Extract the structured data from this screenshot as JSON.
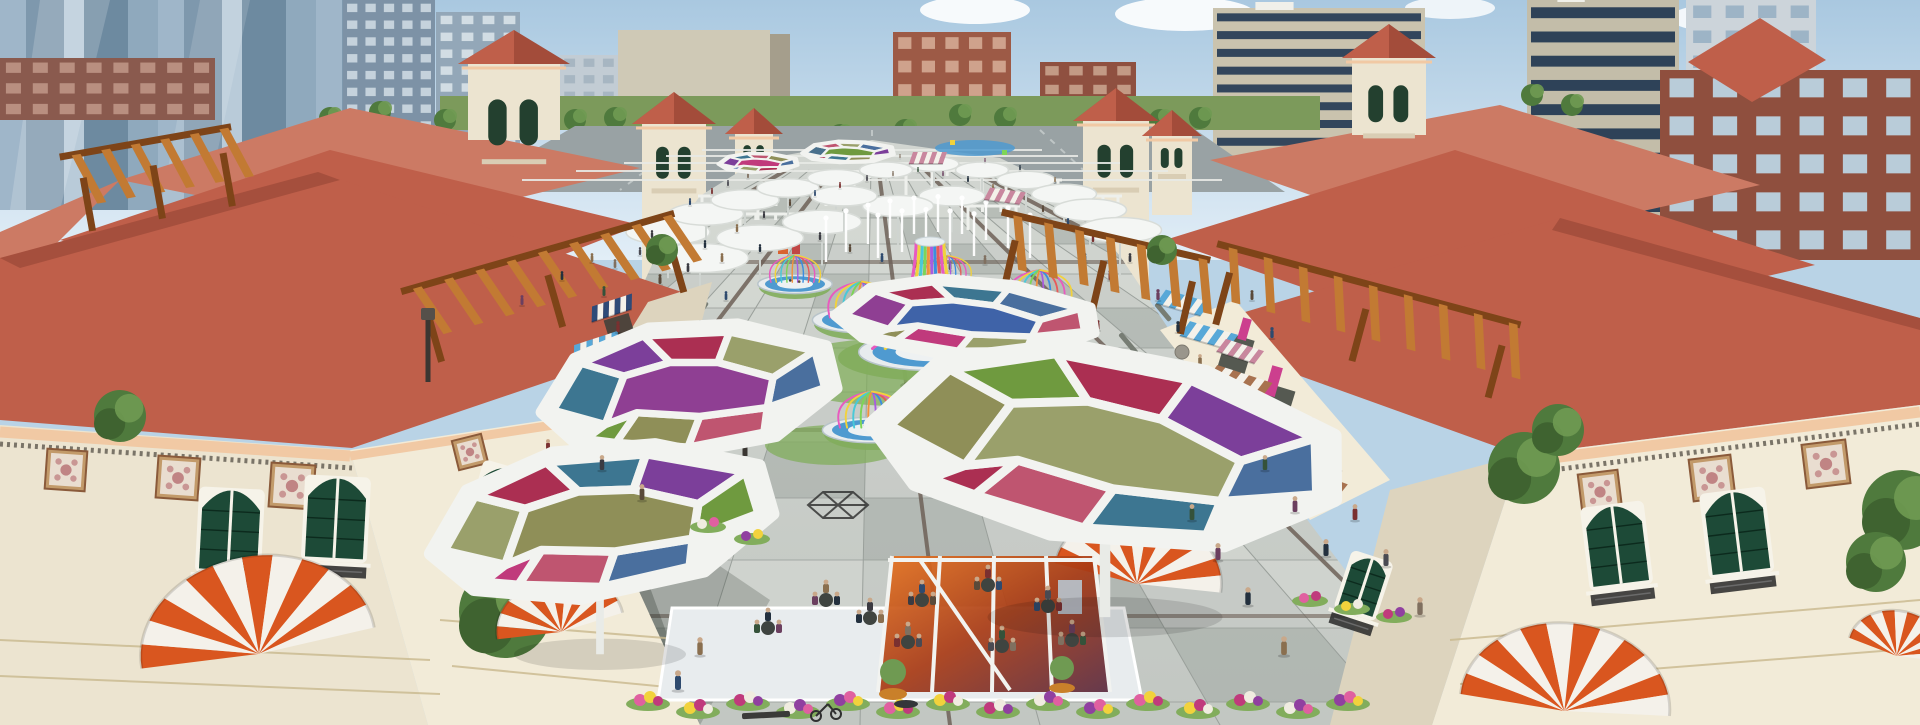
{
  "scene": {
    "title": "Aerial architectural rendering of a Mediterranean-style outdoor shopping plaza with colorful canopies"
  },
  "palette": {
    "skyTop": "#a9c8e0",
    "skyBot": "#e2eef7",
    "cloud": "#ffffff",
    "roofMain": "#bf5f4a",
    "roofPale": "#cc7a64",
    "roofDark": "#a34c3a",
    "roofLine": "#8c3f2f",
    "wallCream": "#ece4d0",
    "wallLit": "#f2ebd8",
    "wallShade": "#ddd4be",
    "stoneBase": "#d8c89e",
    "cornice": "#f1c9a4",
    "frieze": "#7a7468",
    "frameWhite": "#f6f3e9",
    "greenWindow": "#1d4a37",
    "ironDark": "#2e2e2e",
    "woodPergola": "#c27a33",
    "woodDark": "#7e4418",
    "awnOrange": "#d9561f",
    "awnBrown": "#a8724f",
    "awnBlue": "#57a8d8",
    "awnNavy": "#2e4a78",
    "awnPink": "#c9879e",
    "signMagenta": "#cc3f8e",
    "paveLight": "#d7dad5",
    "paveMid": "#c6cbc6",
    "paveDark": "#a3a9a4",
    "joint": "#9aa09b",
    "accentBrown": "#6e6158",
    "grass": "#7c9a5b",
    "lawn": "#82ad5c",
    "treeGreen": "#4f7a3d",
    "treeLight": "#6f9a52",
    "road": "#99a2a4",
    "waterBlue": "#4f9ad0",
    "platform": "#e8ecee",
    "rimGray": "#b8c4ca",
    "olive": "#8f8f58",
    "sage": "#9aa06b",
    "leaf": "#6f9a3f",
    "teal": "#3d7691",
    "steel": "#49708c",
    "blue": "#3f63a8",
    "plum": "#7c3f9a",
    "violet": "#8f3f93",
    "crimson": "#ab2f52",
    "rose": "#bf5570",
    "magenta": "#c03a7c",
    "denim": "#4a6f9e"
  },
  "rainbow": [
    "#e85abf",
    "#f2d23c",
    "#49c9d8",
    "#7ed557",
    "#f2913c",
    "#a95ce0",
    "#3c8de0",
    "#e85a5a"
  ],
  "city": {
    "glassStripes": {
      "x": 0,
      "y": 0,
      "w": 345,
      "h": 210,
      "colors": [
        "#9fb6c9",
        "#7e98ad",
        "#b9cbd9",
        "#6d8aa0",
        "#8fa9bd"
      ]
    },
    "buildings": [
      {
        "name": "left-tower-a",
        "x": 343,
        "y": 0,
        "w": 92,
        "h": 168,
        "body": "#7d92a6",
        "win": "#c5d2dc",
        "rows": 10,
        "cols": 5,
        "type": "grid"
      },
      {
        "name": "left-tower-b",
        "x": 436,
        "y": 12,
        "w": 84,
        "h": 152,
        "body": "#93a7b8",
        "win": "#d2dde4",
        "rows": 9,
        "cols": 4,
        "type": "grid"
      },
      {
        "name": "left-brick-low",
        "x": 0,
        "y": 58,
        "w": 215,
        "h": 62,
        "body": "#8a5a4e",
        "win": "#b98f80",
        "rows": 3,
        "cols": 8,
        "type": "grid"
      },
      {
        "name": "white-slab",
        "x": 560,
        "y": 55,
        "w": 58,
        "h": 66,
        "body": "#c2ccd4",
        "win": "#a7b6c2",
        "rows": 4,
        "cols": 3,
        "type": "grid"
      },
      {
        "name": "beige-block",
        "x": 618,
        "y": 30,
        "w": 152,
        "h": 96,
        "body": "#cfc9b6",
        "win": "#b1aa96",
        "rows": 0,
        "cols": 0,
        "type": "flat"
      },
      {
        "name": "beige-block-side",
        "x": 770,
        "y": 34,
        "w": 20,
        "h": 92,
        "body": "#a59e8c",
        "win": "#a59e8c",
        "rows": 0,
        "cols": 0,
        "type": "flat"
      },
      {
        "name": "red-brick-center",
        "x": 893,
        "y": 32,
        "w": 118,
        "h": 94,
        "body": "#9d5a46",
        "win": "#cfa28c",
        "rows": 4,
        "cols": 5,
        "type": "grid"
      },
      {
        "name": "red-brick-annex",
        "x": 1040,
        "y": 62,
        "w": 96,
        "h": 56,
        "body": "#8f5040",
        "win": "#c39a85",
        "rows": 3,
        "cols": 4,
        "type": "grid"
      },
      {
        "name": "right-residential",
        "x": 1213,
        "y": 8,
        "w": 212,
        "h": 160,
        "body": "#cac3ae",
        "win": "#33465c",
        "rows": 9,
        "cols": 1,
        "type": "bands"
      },
      {
        "name": "far-right-tower-a",
        "x": 1527,
        "y": 0,
        "w": 152,
        "h": 315,
        "body": "#c3bda9",
        "win": "#2e4258",
        "rows": 13,
        "cols": 1,
        "type": "bands"
      },
      {
        "name": "far-right-tower-b",
        "x": 1686,
        "y": 0,
        "w": 130,
        "h": 150,
        "body": "#ccd4da",
        "win": "#9db4c6",
        "rows": 6,
        "cols": 4,
        "type": "grid"
      },
      {
        "name": "far-right-brick",
        "x": 1660,
        "y": 70,
        "w": 260,
        "h": 190,
        "body": "#8f4f3e",
        "win": "#b9ccd9",
        "rows": 5,
        "cols": 6,
        "type": "grid"
      }
    ],
    "trees": [
      [
        330,
        118
      ],
      [
        380,
        112
      ],
      [
        445,
        120
      ],
      [
        520,
        116
      ],
      [
        575,
        120
      ],
      [
        615,
        118
      ],
      [
        960,
        115
      ],
      [
        1005,
        118
      ],
      [
        1160,
        120
      ],
      [
        1200,
        118
      ],
      [
        1445,
        150
      ],
      [
        1490,
        160
      ],
      [
        1060,
        228
      ],
      [
        1012,
        242
      ],
      [
        482,
        215
      ],
      [
        446,
        230
      ],
      [
        1532,
        95
      ],
      [
        1572,
        105
      ],
      [
        905,
        130
      ],
      [
        840,
        135
      ]
    ]
  },
  "medTowers": [
    {
      "x": 642,
      "w": 64,
      "top": 118,
      "bot": 305,
      "apex": 92
    },
    {
      "x": 735,
      "w": 38,
      "top": 128,
      "bot": 215,
      "apex": 108
    },
    {
      "x": 1083,
      "w": 66,
      "top": 115,
      "bot": 300,
      "apex": 88
    },
    {
      "x": 1152,
      "w": 40,
      "top": 130,
      "bot": 215,
      "apex": 110
    },
    {
      "x": 468,
      "w": 92,
      "top": 58,
      "bot": 140,
      "apex": 30
    },
    {
      "x": 1352,
      "w": 74,
      "top": 52,
      "bot": 135,
      "apex": 24
    }
  ],
  "canopies": [
    {
      "cx": 848,
      "cy": 152,
      "rx": 46,
      "ry": 14,
      "rot": 0,
      "colors": [
        "steel",
        "rose",
        "sage",
        "denim",
        "plum",
        "olive",
        "teal",
        "crimson",
        "leaf",
        "steel"
      ]
    },
    {
      "cx": 758,
      "cy": 163,
      "rx": 40,
      "ry": 13,
      "rot": 0,
      "colors": [
        "plum",
        "teal",
        "rose",
        "olive",
        "denim",
        "crimson",
        "sage",
        "blue",
        "magenta",
        "steel"
      ]
    },
    {
      "cx": 965,
      "cy": 318,
      "rx": 130,
      "ry": 50,
      "rot": 3,
      "colors": [
        "violet",
        "crimson",
        "teal",
        "denim",
        "rose",
        "sage",
        "magenta",
        "olive",
        "blue",
        "plum"
      ]
    },
    {
      "cx": 688,
      "cy": 390,
      "rx": 148,
      "ry": 86,
      "rot": -6,
      "colors": [
        "teal",
        "plum",
        "crimson",
        "sage",
        "denim",
        "rose",
        "olive",
        "leaf",
        "violet",
        "steel"
      ]
    },
    {
      "cx": 1105,
      "cy": 447,
      "rx": 235,
      "ry": 126,
      "rot": 8,
      "colors": [
        "olive",
        "leaf",
        "crimson",
        "plum",
        "denim",
        "teal",
        "rose",
        "crimson",
        "sage",
        "blue"
      ]
    },
    {
      "cx": 600,
      "cy": 522,
      "rx": 172,
      "ry": 98,
      "rot": -8,
      "colors": [
        "sage",
        "crimson",
        "teal",
        "plum",
        "leaf",
        "denim",
        "rose",
        "magenta",
        "olive",
        "crimson"
      ]
    }
  ],
  "pavilions": [
    {
      "cx": 795,
      "cy": 284,
      "s": 0.6,
      "t": "dome"
    },
    {
      "cx": 948,
      "cy": 282,
      "s": 0.55,
      "t": "dome"
    },
    {
      "cx": 862,
      "cy": 320,
      "s": 0.8,
      "t": "dome"
    },
    {
      "cx": 1040,
      "cy": 306,
      "s": 0.75,
      "t": "dome"
    },
    {
      "cx": 930,
      "cy": 352,
      "s": 1.15,
      "t": "vase"
    },
    {
      "cx": 872,
      "cy": 430,
      "s": 0.8,
      "t": "dome"
    },
    {
      "cx": 1088,
      "cy": 410,
      "s": 0.85,
      "t": "dome"
    },
    {
      "cx": 1012,
      "cy": 464,
      "s": 1.25,
      "t": "vase"
    }
  ],
  "umbrellas": [
    [
      668,
      232
    ],
    [
      706,
      214
    ],
    [
      745,
      200
    ],
    [
      788,
      188
    ],
    [
      836,
      178
    ],
    [
      886,
      170
    ],
    [
      934,
      164
    ],
    [
      982,
      170
    ],
    [
      1026,
      180
    ],
    [
      1064,
      194
    ],
    [
      700,
      258
    ],
    [
      760,
      238
    ],
    [
      822,
      222
    ],
    [
      1090,
      210
    ],
    [
      952,
      196
    ],
    [
      898,
      206
    ],
    [
      844,
      196
    ],
    [
      1120,
      230
    ]
  ],
  "jets": [
    [
      826,
      262
    ],
    [
      846,
      252
    ],
    [
      868,
      244
    ],
    [
      890,
      238
    ],
    [
      914,
      234
    ],
    [
      938,
      232
    ],
    [
      962,
      234
    ],
    [
      986,
      240
    ],
    [
      1008,
      248
    ],
    [
      1030,
      258
    ],
    [
      878,
      258
    ],
    [
      902,
      252
    ],
    [
      926,
      250
    ],
    [
      950,
      252
    ],
    [
      974,
      256
    ]
  ],
  "whiteFrames": [
    [
      698,
      196,
      64
    ],
    [
      772,
      182,
      58
    ],
    [
      850,
      172,
      60
    ],
    [
      928,
      170,
      58
    ],
    [
      1002,
      180,
      60
    ],
    [
      1066,
      196,
      56
    ],
    [
      736,
      214,
      60
    ],
    [
      964,
      206,
      56
    ]
  ],
  "people": {
    "far": [
      [
        652,
        238,
        8
      ],
      [
        672,
        220,
        7
      ],
      [
        690,
        205,
        7
      ],
      [
        712,
        194,
        6
      ],
      [
        728,
        186,
        6
      ],
      [
        748,
        178,
        6
      ],
      [
        770,
        170,
        5
      ],
      [
        795,
        163,
        5
      ],
      [
        705,
        248,
        8
      ],
      [
        737,
        232,
        8
      ],
      [
        764,
        218,
        7
      ],
      [
        790,
        206,
        7
      ],
      [
        815,
        196,
        6
      ],
      [
        840,
        188,
        6
      ],
      [
        867,
        181,
        6
      ],
      [
        893,
        176,
        5
      ],
      [
        918,
        172,
        5
      ],
      [
        943,
        176,
        5
      ],
      [
        968,
        182,
        6
      ],
      [
        993,
        190,
        6
      ],
      [
        1018,
        200,
        7
      ],
      [
        1043,
        212,
        7
      ],
      [
        1068,
        226,
        8
      ],
      [
        1093,
        242,
        8
      ],
      [
        940,
        160,
        4
      ],
      [
        900,
        158,
        4
      ],
      [
        862,
        156,
        4
      ],
      [
        985,
        162,
        4
      ],
      [
        1020,
        170,
        5
      ],
      [
        1055,
        182,
        5
      ],
      [
        820,
        240,
        8
      ],
      [
        850,
        252,
        8
      ],
      [
        882,
        262,
        9
      ],
      [
        915,
        268,
        9
      ],
      [
        950,
        270,
        9
      ],
      [
        985,
        264,
        9
      ],
      [
        1020,
        252,
        8
      ],
      [
        1050,
        240,
        8
      ],
      [
        760,
        252,
        8
      ],
      [
        722,
        262,
        9
      ],
      [
        688,
        272,
        9
      ],
      [
        660,
        284,
        10
      ],
      [
        1085,
        262,
        9
      ],
      [
        1110,
        280,
        10
      ],
      [
        640,
        255,
        8
      ],
      [
        615,
        268,
        9
      ]
    ],
    "mid": [
      [
        618,
        332,
        11
      ],
      [
        640,
        372,
        12
      ],
      [
        664,
        412,
        13
      ],
      [
        604,
        296,
        10
      ],
      [
        1158,
        300,
        11
      ],
      [
        1178,
        332,
        11
      ],
      [
        1200,
        366,
        12
      ],
      [
        1224,
        402,
        13
      ],
      [
        1252,
        300,
        10
      ],
      [
        1272,
        338,
        11
      ],
      [
        548,
        452,
        13
      ],
      [
        1312,
        430,
        13
      ],
      [
        1338,
        470,
        14
      ],
      [
        1242,
        440,
        13
      ],
      [
        522,
        305,
        10
      ],
      [
        562,
        280,
        9
      ],
      [
        592,
        262,
        9
      ],
      [
        1130,
        262,
        9
      ],
      [
        700,
        330,
        10
      ],
      [
        726,
        300,
        9
      ],
      [
        1098,
        330,
        10
      ],
      [
        1120,
        360,
        11
      ]
    ],
    "near": [
      [
        1192,
        520,
        16
      ],
      [
        1218,
        560,
        17
      ],
      [
        1248,
        605,
        18
      ],
      [
        1284,
        655,
        19
      ],
      [
        602,
        470,
        15
      ],
      [
        642,
        500,
        16
      ],
      [
        678,
        690,
        20
      ],
      [
        1355,
        520,
        16
      ],
      [
        1386,
        566,
        17
      ],
      [
        1420,
        615,
        18
      ],
      [
        1265,
        470,
        15
      ],
      [
        1295,
        512,
        16
      ],
      [
        1326,
        556,
        17
      ],
      [
        700,
        655,
        18
      ]
    ],
    "colors": [
      "#3b3b42",
      "#5a4a3a",
      "#2e4a6e",
      "#7a3030",
      "#4a4a52",
      "#807060",
      "#35523a",
      "#6b3f5f",
      "#23303e",
      "#8a6f4f"
    ]
  },
  "tables": [
    [
      922,
      600
    ],
    [
      988,
      585
    ],
    [
      1048,
      606
    ],
    [
      908,
      642
    ],
    [
      1002,
      646
    ],
    [
      1072,
      640
    ],
    [
      768,
      628
    ],
    [
      826,
      600
    ],
    [
      870,
      618
    ]
  ],
  "flowers": {
    "rowStartX": 648,
    "rowEndX": 1348,
    "step": 50,
    "colors": [
      "#e060a0",
      "#f2d23c",
      "#c03a7c",
      "#f0ece0",
      "#9040a0"
    ],
    "beds": [
      [
        1310,
        598
      ],
      [
        1352,
        606
      ],
      [
        1394,
        614
      ],
      [
        708,
        524
      ],
      [
        752,
        536
      ]
    ]
  },
  "domes": [
    {
      "cx": 258,
      "cy": 648,
      "r": 118,
      "rot": -10
    },
    {
      "cx": 560,
      "cy": 626,
      "r": 64,
      "rot": -12
    },
    {
      "cx": 1138,
      "cy": 578,
      "r": 84,
      "rot": 10
    },
    {
      "cx": 1565,
      "cy": 705,
      "r": 105,
      "rot": 6
    },
    {
      "cx": 1898,
      "cy": 650,
      "r": 50,
      "rot": 14
    }
  ],
  "shopAwnings": [
    {
      "x": 612,
      "y": 300,
      "w": 42,
      "h": 15,
      "rot": -18,
      "c": "awnNavy"
    },
    {
      "x": 596,
      "y": 338,
      "w": 46,
      "h": 16,
      "rot": -18,
      "c": "awnBlue"
    },
    {
      "x": 580,
      "y": 382,
      "w": 52,
      "h": 18,
      "rot": -18,
      "c": "awnBrown"
    },
    {
      "x": 1188,
      "y": 296,
      "w": 46,
      "h": 16,
      "rot": 16,
      "c": "awnBlue"
    },
    {
      "x": 1214,
      "y": 328,
      "w": 50,
      "h": 17,
      "rot": 16,
      "c": "awnBlue"
    },
    {
      "x": 1245,
      "y": 374,
      "w": 58,
      "h": 19,
      "rot": 18,
      "c": "awnBrown"
    },
    {
      "x": 1278,
      "y": 422,
      "w": 64,
      "h": 21,
      "rot": 18,
      "c": "awnBrown"
    },
    {
      "x": 1314,
      "y": 472,
      "w": 72,
      "h": 23,
      "rot": 20,
      "c": "awnBrown"
    },
    {
      "x": 930,
      "y": 152,
      "w": 34,
      "h": 12,
      "rot": 0,
      "c": "awnPink"
    },
    {
      "x": 1008,
      "y": 190,
      "w": 36,
      "h": 13,
      "rot": 8,
      "c": "awnPink"
    },
    {
      "x": 1245,
      "y": 345,
      "w": 40,
      "h": 15,
      "rot": 18,
      "c": "awnPink"
    }
  ],
  "pergolas": [
    {
      "cx": 545,
      "cy": 278,
      "w": 260,
      "rot": -16,
      "n": 9
    },
    {
      "cx": 150,
      "cy": 168,
      "w": 150,
      "rot": -10,
      "n": 6
    },
    {
      "cx": 1100,
      "cy": 262,
      "w": 190,
      "rot": 13,
      "n": 7
    },
    {
      "cx": 1362,
      "cy": 310,
      "w": 290,
      "rot": 15,
      "n": 9
    }
  ],
  "foliage": [
    {
      "x": 505,
      "y": 612,
      "r": 46
    },
    {
      "x": 545,
      "y": 560,
      "r": 30
    },
    {
      "x": 120,
      "y": 416,
      "r": 26
    },
    {
      "x": 1524,
      "y": 468,
      "r": 36
    },
    {
      "x": 1558,
      "y": 430,
      "r": 26
    },
    {
      "x": 1902,
      "y": 510,
      "r": 40
    },
    {
      "x": 1876,
      "y": 562,
      "r": 30
    },
    {
      "x": 700,
      "y": 432,
      "r": 18
    },
    {
      "x": 1235,
      "y": 430,
      "r": 16
    },
    {
      "x": 1262,
      "y": 468,
      "r": 18
    },
    {
      "x": 662,
      "y": 250,
      "r": 16
    },
    {
      "x": 1162,
      "y": 250,
      "r": 15
    }
  ],
  "stoneBalls": [
    [
      1245,
      438
    ],
    [
      1212,
      392
    ],
    [
      1182,
      352
    ],
    [
      655,
      330
    ]
  ],
  "lamps": [
    {
      "x": 428,
      "y": 318
    },
    {
      "x": 745,
      "y": 392
    }
  ],
  "benches": [
    [
      690,
      322,
      26,
      -55
    ],
    [
      748,
      362,
      30,
      -55
    ],
    [
      1122,
      332,
      26,
      50
    ],
    [
      1158,
      302,
      22,
      50
    ]
  ],
  "sculpture": {
    "x": 838,
    "y": 505,
    "r": 30
  }
}
